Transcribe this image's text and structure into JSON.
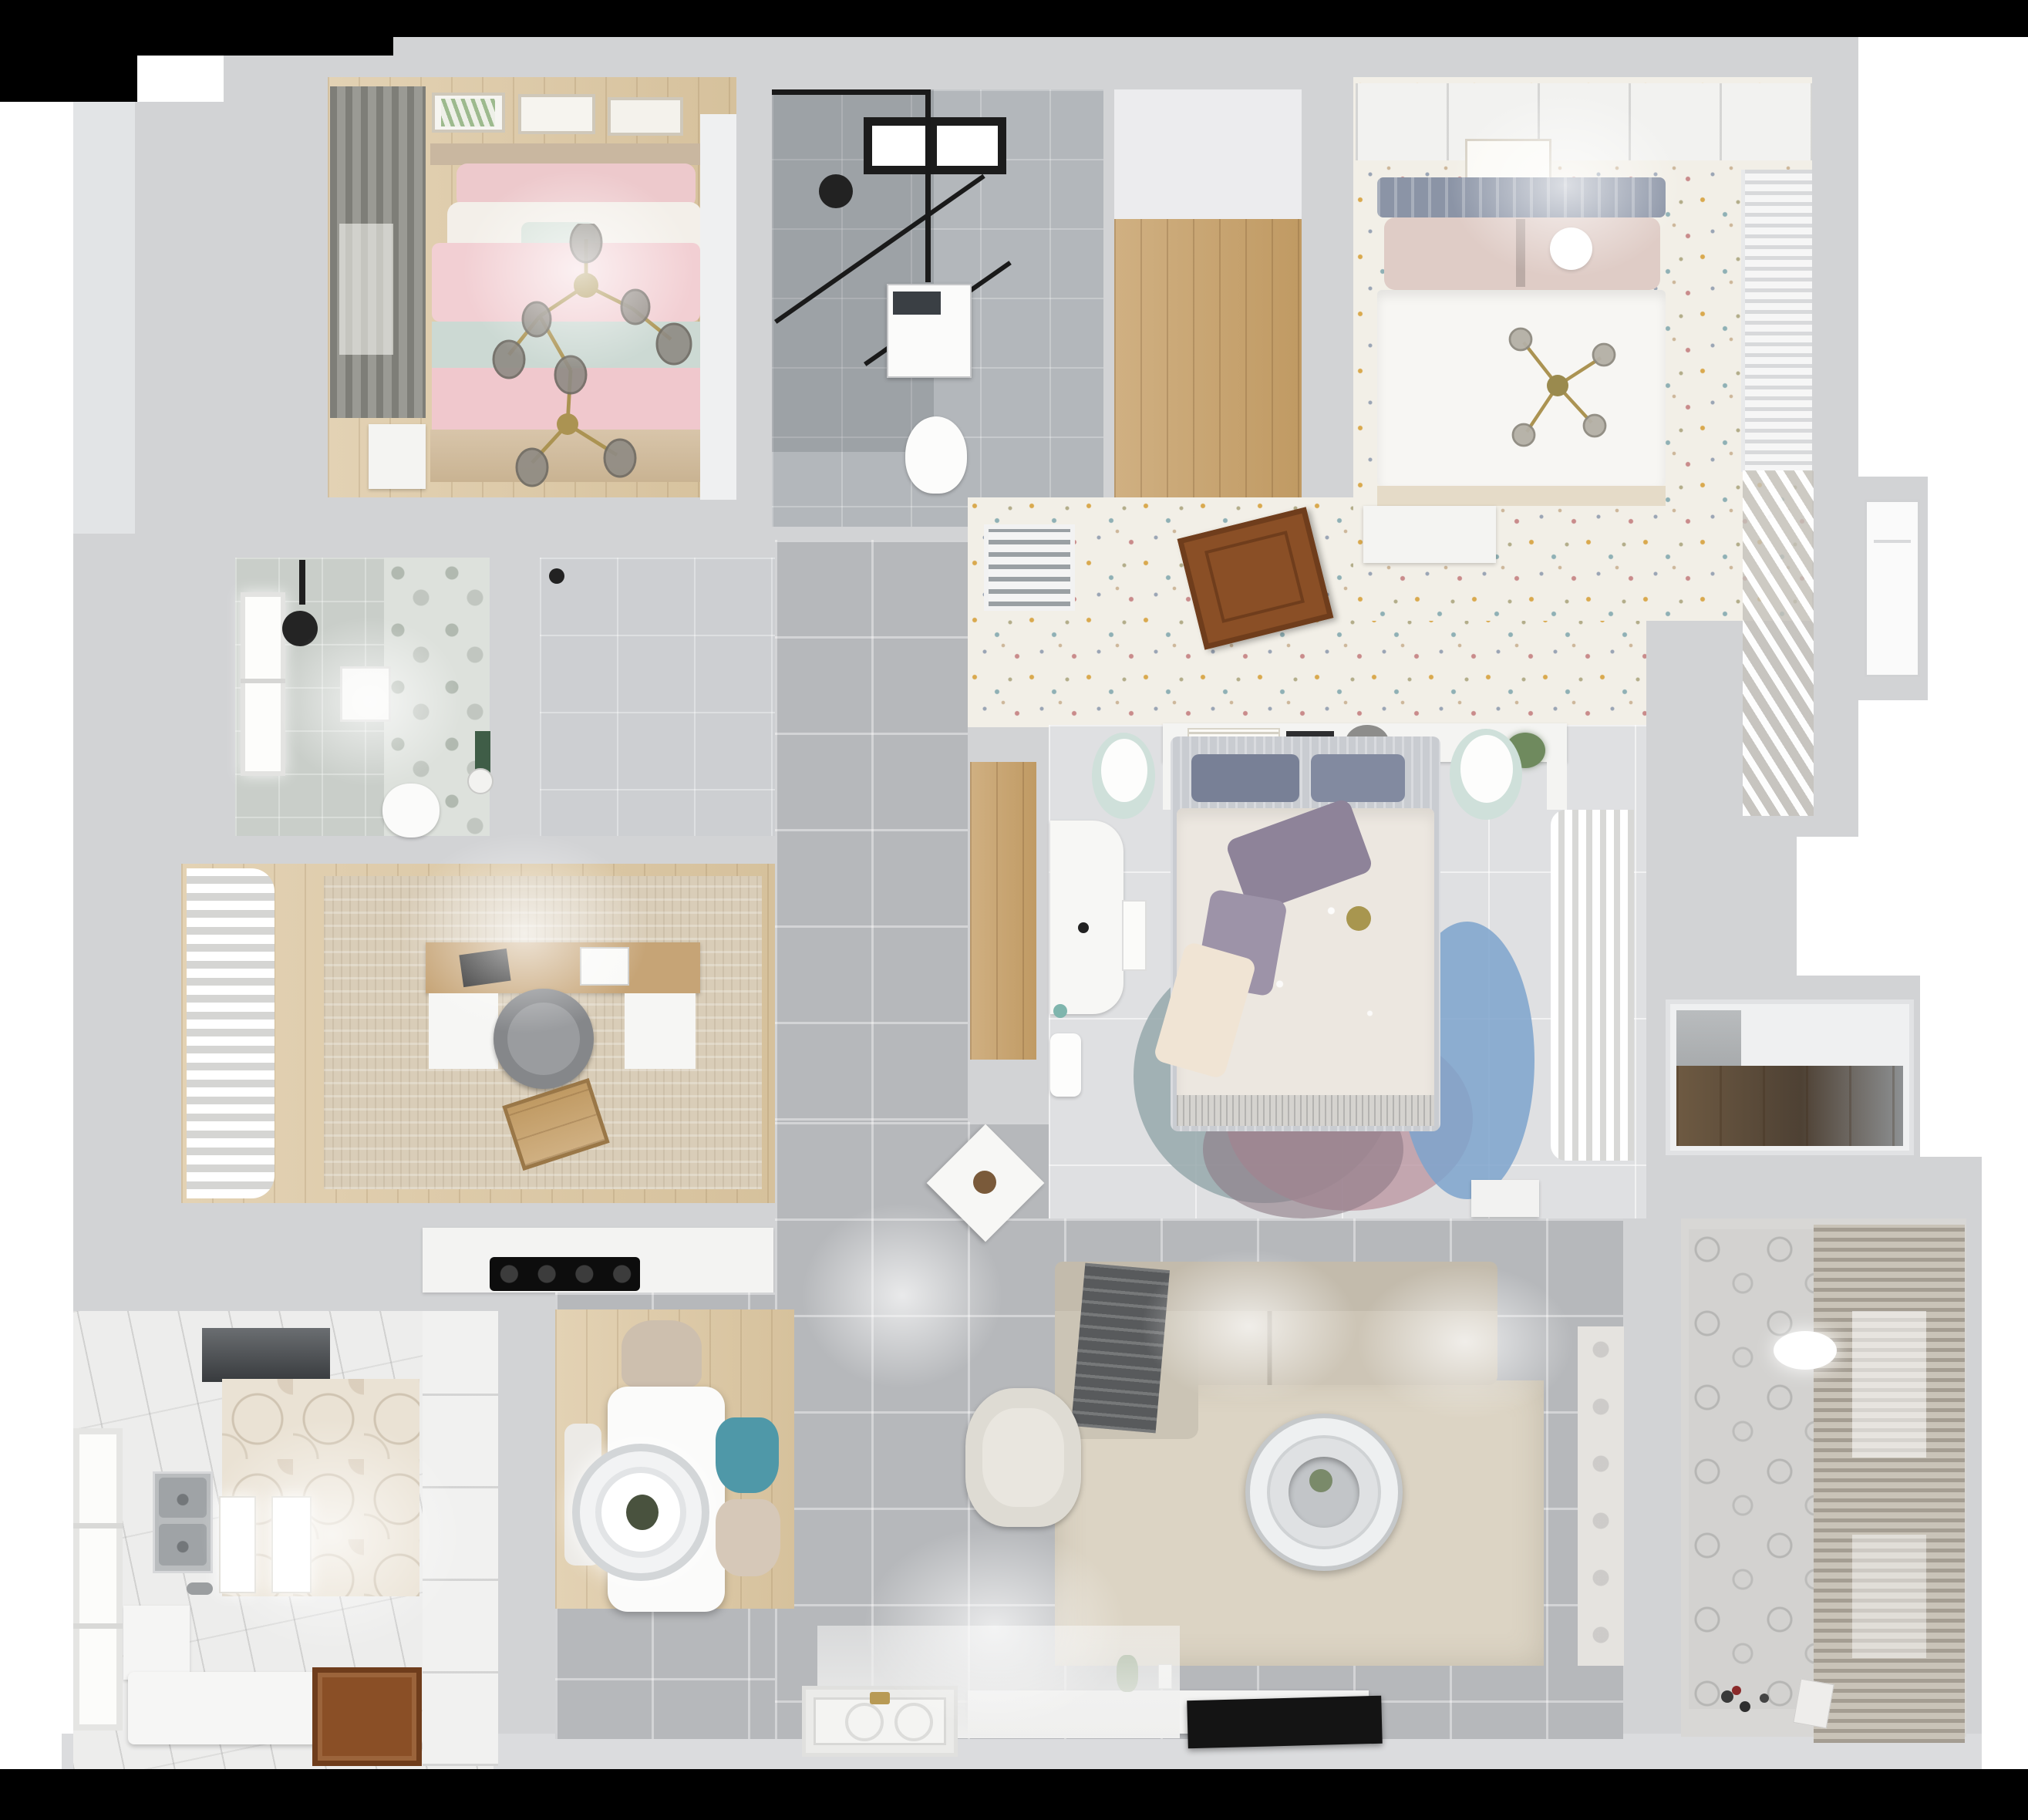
{
  "scene": {
    "title": "Top-down 3D dollhouse render of a three-bedroom apartment",
    "view": "orthographic top-down cutaway, walls sliced",
    "background": "white with black letterbox bars top and bottom",
    "rooms": [
      {
        "id": "bedroom-pink",
        "label": "Secondary bedroom (pink bedding)",
        "position": "top-left",
        "furniture": [
          "double bed with pink patterned duvet",
          "mint throw band",
          "white and blush pillows",
          "gold branch chandelier with smoked-glass globes",
          "gray window drapes",
          "three botanical wall art frames",
          "white nightstand",
          "white wardrobe strip"
        ]
      },
      {
        "id": "bathroom-main",
        "label": "Main bathroom",
        "position": "top-center",
        "furniture": [
          "black-framed walk-in shower",
          "skylight window",
          "round black mirror",
          "washing machine",
          "toilet"
        ]
      },
      {
        "id": "walkin-hall",
        "label": "Walk-in closet hallway (wood floor)",
        "position": "top-center-right",
        "furniture": []
      },
      {
        "id": "bedroom-master",
        "label": "Master bedroom",
        "position": "top-right",
        "furniture": [
          "double bed with white duvet",
          "slate gray headboard",
          "blush pillows",
          "gold cross chandelier",
          "white paneled wall with framed print",
          "louvered wardrobe",
          "sheer diagonal curtains",
          "white bench"
        ]
      },
      {
        "id": "corridor",
        "label": "Corridor with terrazzo-speckle floor",
        "position": "center",
        "furniture": [
          "white floor vent grille",
          "open wooden door leaf"
        ]
      },
      {
        "id": "bathroom-second",
        "label": "Second bathroom",
        "position": "mid-left",
        "furniture": [
          "window",
          "black rain shower head",
          "framed print",
          "floral accent wall",
          "green accent strip",
          "toilet",
          "small basin"
        ]
      },
      {
        "id": "study",
        "label": "Study / home office",
        "position": "center-left",
        "furniture": [
          "billowy white curtains",
          "wood desk with white pedestals",
          "dark laptop",
          "white printer",
          "gray round office chair",
          "wooden crate on rug",
          "beige mottled rug"
        ]
      },
      {
        "id": "bedroom-middle",
        "label": "Middle bedroom",
        "position": "center",
        "furniture": [
          "bed with cream floral duvet",
          "purple pillows",
          "white headboard shelf with books",
          "two mint nightstands",
          "white desk",
          "sheer wardrobe curtains",
          "round petal rug in gray, pink and blue",
          "white storage box"
        ]
      },
      {
        "id": "kitchen",
        "label": "Kitchen",
        "position": "bottom-left",
        "furniture": [
          "hexagon tile accent wall",
          "dark range hood",
          "black four-burner cooktop",
          "stainless double sink",
          "white counters and island",
          "tall white cabinets",
          "wooden door",
          "side window"
        ]
      },
      {
        "id": "dining",
        "label": "Dining area",
        "position": "bottom-center-left",
        "furniture": [
          "white rectangular table",
          "ring pendant lamp",
          "teal chair",
          "two beige chairs",
          "white chair",
          "pale wood rug"
        ]
      },
      {
        "id": "living",
        "label": "Living room",
        "position": "bottom-center-right",
        "furniture": [
          "L-shaped beige sectional sofa",
          "dark gray throw blanket",
          "large cream rug",
          "round white coffee table",
          "white armchair",
          "diamond side table with plant",
          "white media console",
          "flat TV against wall",
          "potted plant",
          "entry door mat with brass handle"
        ]
      },
      {
        "id": "balcony",
        "label": "Balcony / utility room",
        "position": "bottom-right",
        "furniture": [
          "patterned tile wall",
          "full-height venetian blinds",
          "round ceiling lamp",
          "toys on floor",
          "paper bag"
        ]
      },
      {
        "id": "closet-niche",
        "label": "Storage niche with wood shelf",
        "position": "right",
        "furniture": [
          "wood-lined niche"
        ]
      }
    ],
    "palette": {
      "wall": "#d2d3d5",
      "wall_light": "#e2e4e6",
      "tile": "#b6b8bb",
      "tile_light": "#dfe0e2",
      "marble": "#b3b7bb",
      "speckle_base": "#f2efe7",
      "wood": "#c6a476",
      "wood_dark": "#8a4f26",
      "wood_floor": "#d9c7a8",
      "pink_duvet": "#f2cfd3",
      "mint": "#ccd9d3",
      "blush": "#dfccc6",
      "slate": "#8b94a6",
      "master_duvet": "#f7f6f3",
      "mid_duvet": "#ece7e0",
      "purple": "#8e8399",
      "sofa": "#cdc5b6",
      "sofa_back": "#c3bbac",
      "rug_living": "#dcd4c4",
      "teal": "#4f98a8",
      "rug_blue": "#7ea3cc",
      "rug_pink": "#bb97a2",
      "rug_gray": "#97a8ac",
      "curtain": "#f3f3f1",
      "drape": "#85857f",
      "blinds": "#a49d92",
      "hex_wall": "#eae2d4",
      "counter": "#f3f3f2",
      "tv": "#141414",
      "gold": "#ab9352",
      "door_brown": "#8a4f26",
      "hood": "#4a4e52",
      "black_bar": "#000000",
      "green_plant": "#6f8a5e"
    }
  }
}
